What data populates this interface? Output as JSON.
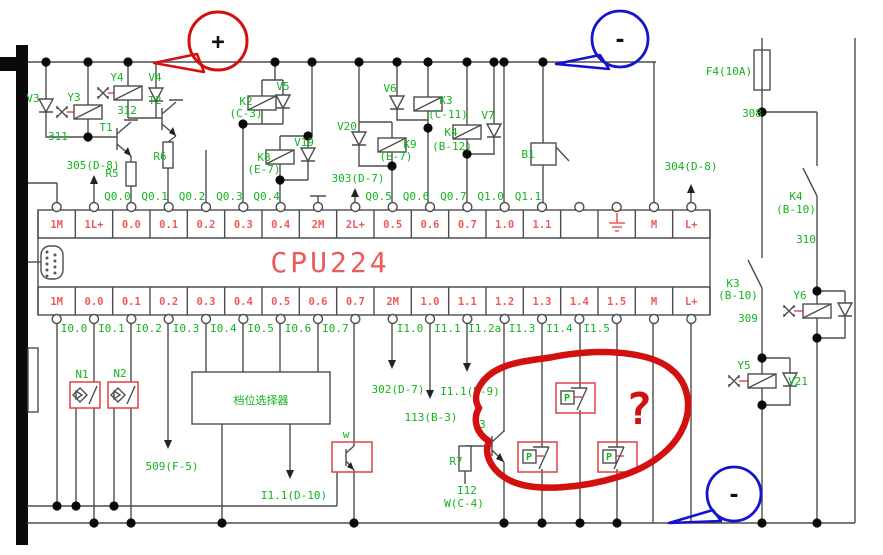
{
  "annotations": {
    "plus": "+",
    "minus_top": "-",
    "minus_bottom": "-",
    "question": "?"
  },
  "colors": {
    "label_green": "#12b41e",
    "terminal_red": "#ee5a5a",
    "annotation_red": "#d31010",
    "annotation_blue": "#1414cf",
    "wire_gray": "#4d4d4d"
  },
  "cpu": {
    "title": "CPU224",
    "top_terminals": [
      "1M",
      "1L+",
      "0.0",
      "0.1",
      "0.2",
      "0.3",
      "0.4",
      "2M",
      "2L+",
      "0.5",
      "0.6",
      "0.7",
      "1.0",
      "1.1",
      "",
      "GND",
      "M",
      "L+"
    ],
    "ground_symbol_cell": 15,
    "bottom_terminals": [
      "1M",
      "0.0",
      "0.1",
      "0.2",
      "0.3",
      "0.4",
      "0.5",
      "0.6",
      "0.7",
      "2M",
      "1.0",
      "1.1",
      "1.2",
      "1.3",
      "1.4",
      "1.5",
      "M",
      "L+"
    ]
  },
  "output_labels": [
    "Q0.0",
    "Q0.1",
    "Q0.2",
    "Q0.3",
    "Q0.4",
    "Q0.5",
    "Q0.6",
    "Q0.7",
    "Q1.0",
    "Q1.1"
  ],
  "input_labels": [
    "I0.0",
    "I0.1",
    "I0.2",
    "I0.3",
    "I0.4",
    "I0.5",
    "I0.6",
    "I0.7",
    "I1.0",
    "I1.1",
    "I1.2a",
    "I1.3",
    "I1.4",
    "I1.5"
  ],
  "p_switch_label": "P",
  "component_labels": [
    {
      "id": "v3",
      "text": "V3"
    },
    {
      "id": "y3",
      "text": "Y3"
    },
    {
      "id": "wire311",
      "text": "311"
    },
    {
      "id": "y4",
      "text": "Y4"
    },
    {
      "id": "v4",
      "text": "V4"
    },
    {
      "id": "wire312",
      "text": "312"
    },
    {
      "id": "t1",
      "text": "T1"
    },
    {
      "id": "r5",
      "text": "R5"
    },
    {
      "id": "t2",
      "text": "T2"
    },
    {
      "id": "r6",
      "text": "R6"
    },
    {
      "id": "ref305",
      "text": "305(D-8)"
    },
    {
      "id": "k2",
      "text": "K2"
    },
    {
      "id": "k2loc",
      "text": "(C-3)"
    },
    {
      "id": "v5",
      "text": "V5"
    },
    {
      "id": "k8",
      "text": "K8"
    },
    {
      "id": "k8loc",
      "text": "(E-7)"
    },
    {
      "id": "v19",
      "text": "V19"
    },
    {
      "id": "v20",
      "text": "V20"
    },
    {
      "id": "k9",
      "text": "K9"
    },
    {
      "id": "k9loc",
      "text": "(E-7)"
    },
    {
      "id": "ref303",
      "text": "303(D-7)"
    },
    {
      "id": "v6",
      "text": "V6"
    },
    {
      "id": "k3",
      "text": "K3"
    },
    {
      "id": "k3loc",
      "text": "(C-11)"
    },
    {
      "id": "k4",
      "text": "K4"
    },
    {
      "id": "k4loc",
      "text": "(B-12)"
    },
    {
      "id": "v7",
      "text": "V7"
    },
    {
      "id": "b1",
      "text": "B1"
    },
    {
      "id": "ref304",
      "text": "304(D-8)"
    },
    {
      "id": "f4",
      "text": "F4(10A)"
    },
    {
      "id": "wire308",
      "text": "308"
    },
    {
      "id": "k4b",
      "text": "K4"
    },
    {
      "id": "k4bloc",
      "text": "(B-10)"
    },
    {
      "id": "wire310",
      "text": "310"
    },
    {
      "id": "k3b",
      "text": "K3"
    },
    {
      "id": "k3bloc",
      "text": "(B-10)"
    },
    {
      "id": "wire309",
      "text": "309"
    },
    {
      "id": "y6",
      "text": "Y6"
    },
    {
      "id": "y5",
      "text": "Y5"
    },
    {
      "id": "v21",
      "text": "V21"
    },
    {
      "id": "n1",
      "text": "N1"
    },
    {
      "id": "n2",
      "text": "N2"
    },
    {
      "id": "gear",
      "text": "档位选择器"
    },
    {
      "id": "ref509",
      "text": "509(F-5)"
    },
    {
      "id": "refi11d10",
      "text": "I1.1(D-10)"
    },
    {
      "id": "wlabel",
      "text": "w"
    },
    {
      "id": "ref302",
      "text": "302(D-7)"
    },
    {
      "id": "ref113",
      "text": "113(B-3)"
    },
    {
      "id": "refi11d9",
      "text": "I1.1(D-9)"
    },
    {
      "id": "t3",
      "text": "T3"
    },
    {
      "id": "r7",
      "text": "R7"
    },
    {
      "id": "i12",
      "text": "I12"
    },
    {
      "id": "wc4",
      "text": "W(C-4)"
    }
  ]
}
